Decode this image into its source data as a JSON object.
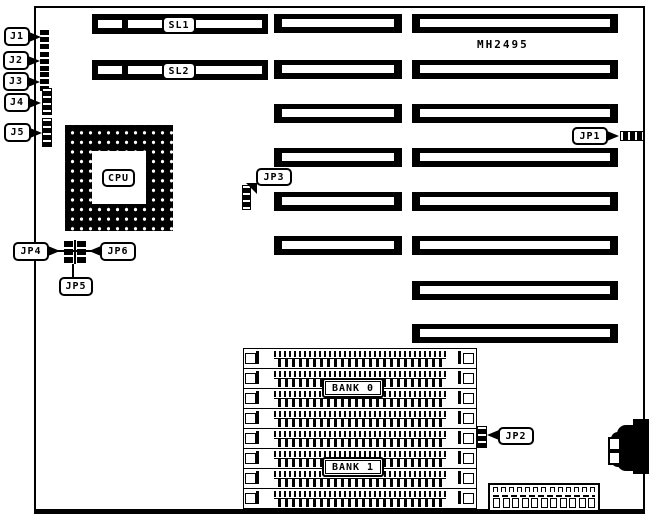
{
  "board": {
    "part_number": "MH2495"
  },
  "left_jumpers": [
    {
      "label": "J1"
    },
    {
      "label": "J2"
    },
    {
      "label": "J3"
    },
    {
      "label": "J4"
    },
    {
      "label": "J5"
    }
  ],
  "cpu": {
    "label": "CPU"
  },
  "config_jumpers": {
    "jp1": "JP1",
    "jp2": "JP2",
    "jp3": "JP3",
    "jp4": "JP4",
    "jp5": "JP5",
    "jp6": "JP6"
  },
  "expansion_slots": {
    "labeled": [
      {
        "label": "SL1"
      },
      {
        "label": "SL2"
      }
    ],
    "middle_count": 6,
    "right_count": 8
  },
  "memory": {
    "socket_count": 8,
    "banks": [
      {
        "label": "BANK 0"
      },
      {
        "label": "BANK 1"
      }
    ]
  }
}
